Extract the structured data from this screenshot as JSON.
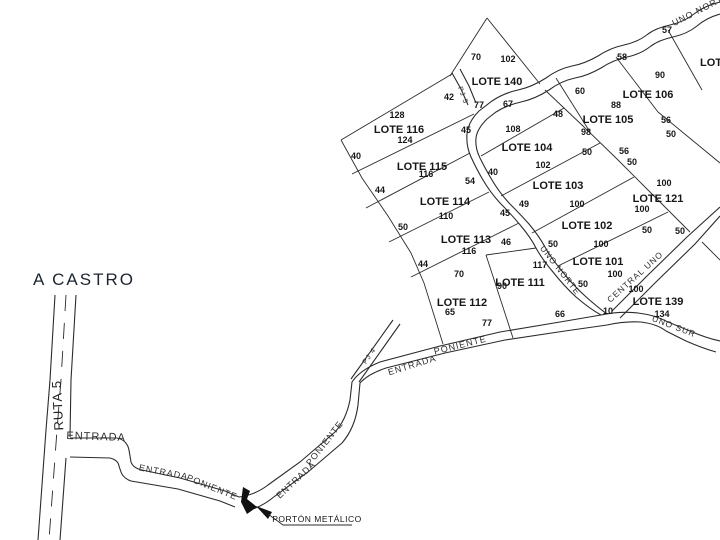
{
  "labels": {
    "a_castro": "A CASTRO",
    "ruta5": "RUTA 5",
    "partial_lot": "LOTE"
  },
  "annotation": {
    "porton": "PORTÓN METÁLICO"
  },
  "colors": {
    "line": "#2b2b2b",
    "text": "#161616",
    "background": "#ffffff"
  },
  "lots": [
    {
      "label": "LOTE 140",
      "x": 497,
      "y": 85
    },
    {
      "label": "LOTE 106",
      "x": 648,
      "y": 98
    },
    {
      "label": "LOTE 105",
      "x": 608,
      "y": 123
    },
    {
      "label": "LOTE 104",
      "x": 527,
      "y": 151
    },
    {
      "label": "LOTE 116",
      "x": 399,
      "y": 133
    },
    {
      "label": "LOTE 115",
      "x": 422,
      "y": 170
    },
    {
      "label": "LOTE 103",
      "x": 558,
      "y": 189
    },
    {
      "label": "LOTE 121",
      "x": 658,
      "y": 202
    },
    {
      "label": "LOTE 114",
      "x": 445,
      "y": 205
    },
    {
      "label": "LOTE 102",
      "x": 587,
      "y": 229
    },
    {
      "label": "LOTE 113",
      "x": 466,
      "y": 243
    },
    {
      "label": "LOTE 101",
      "x": 598,
      "y": 265
    },
    {
      "label": "LOTE 111",
      "x": 520,
      "y": 286
    },
    {
      "label": "LOTE 139",
      "x": 658,
      "y": 305
    },
    {
      "label": "LOTE 112",
      "x": 462,
      "y": 306
    }
  ],
  "dimensions": [
    {
      "t": "70",
      "x": 476,
      "y": 60
    },
    {
      "t": "102",
      "x": 508,
      "y": 62
    },
    {
      "t": "42",
      "x": 449,
      "y": 100
    },
    {
      "t": "77",
      "x": 479,
      "y": 108
    },
    {
      "t": "67",
      "x": 508,
      "y": 107
    },
    {
      "t": "45",
      "x": 466,
      "y": 133
    },
    {
      "t": "108",
      "x": 513,
      "y": 132
    },
    {
      "t": "128",
      "x": 397,
      "y": 118
    },
    {
      "t": "124",
      "x": 405,
      "y": 143
    },
    {
      "t": "40",
      "x": 356,
      "y": 159
    },
    {
      "t": "116",
      "x": 426,
      "y": 177
    },
    {
      "t": "44",
      "x": 380,
      "y": 193
    },
    {
      "t": "54",
      "x": 470,
      "y": 184
    },
    {
      "t": "40",
      "x": 493,
      "y": 175
    },
    {
      "t": "102",
      "x": 543,
      "y": 168
    },
    {
      "t": "48",
      "x": 558,
      "y": 117
    },
    {
      "t": "98",
      "x": 586,
      "y": 135
    },
    {
      "t": "110",
      "x": 446,
      "y": 219
    },
    {
      "t": "50",
      "x": 403,
      "y": 230
    },
    {
      "t": "100",
      "x": 577,
      "y": 207
    },
    {
      "t": "45",
      "x": 505,
      "y": 216
    },
    {
      "t": "49",
      "x": 524,
      "y": 207
    },
    {
      "t": "116",
      "x": 469,
      "y": 254
    },
    {
      "t": "44",
      "x": 423,
      "y": 267
    },
    {
      "t": "46",
      "x": 506,
      "y": 245
    },
    {
      "t": "100",
      "x": 601,
      "y": 247
    },
    {
      "t": "50",
      "x": 553,
      "y": 247
    },
    {
      "t": "70",
      "x": 459,
      "y": 277
    },
    {
      "t": "65",
      "x": 450,
      "y": 315
    },
    {
      "t": "77",
      "x": 487,
      "y": 326
    },
    {
      "t": "90",
      "x": 502,
      "y": 289
    },
    {
      "t": "117",
      "x": 540,
      "y": 268
    },
    {
      "t": "66",
      "x": 560,
      "y": 317
    },
    {
      "t": "100",
      "x": 615,
      "y": 277
    },
    {
      "t": "50",
      "x": 583,
      "y": 287
    },
    {
      "t": "57",
      "x": 667,
      "y": 33
    },
    {
      "t": "58",
      "x": 622,
      "y": 60
    },
    {
      "t": "90",
      "x": 660,
      "y": 78
    },
    {
      "t": "60",
      "x": 580,
      "y": 94
    },
    {
      "t": "88",
      "x": 616,
      "y": 108
    },
    {
      "t": "56",
      "x": 624,
      "y": 154
    },
    {
      "t": "50",
      "x": 632,
      "y": 165
    },
    {
      "t": "56",
      "x": 666,
      "y": 123
    },
    {
      "t": "50",
      "x": 671,
      "y": 137
    },
    {
      "t": "50",
      "x": 587,
      "y": 155
    },
    {
      "t": "100",
      "x": 664,
      "y": 186
    },
    {
      "t": "100",
      "x": 642,
      "y": 212
    },
    {
      "t": "50",
      "x": 647,
      "y": 233
    },
    {
      "t": "50",
      "x": 680,
      "y": 234
    },
    {
      "t": "100",
      "x": 636,
      "y": 292
    },
    {
      "t": "134",
      "x": 662,
      "y": 317
    },
    {
      "t": "10",
      "x": 608,
      "y": 314
    }
  ],
  "road_labels": [
    {
      "t": "UNO NORTE",
      "x": 702,
      "y": 12,
      "r": -27,
      "fs": 9
    },
    {
      "t": "PJ 5",
      "x": 461,
      "y": 96,
      "r": 70,
      "fs": 7
    },
    {
      "t": "UNO NORTE",
      "x": 558,
      "y": 272,
      "r": 52,
      "fs": 8.5
    },
    {
      "t": "CENTRAL UNO",
      "x": 637,
      "y": 279,
      "r": -42,
      "fs": 8.5
    },
    {
      "t": "UNO SUR",
      "x": 673,
      "y": 329,
      "r": 21,
      "fs": 8.5
    },
    {
      "t": "PJ 4",
      "x": 371,
      "y": 357,
      "r": -55,
      "fs": 7
    },
    {
      "t": "ENTRADA",
      "x": 96,
      "y": 440,
      "r": 2,
      "fs": 11
    },
    {
      "t": "ENTRADA",
      "x": 163,
      "y": 475,
      "r": 11,
      "fs": 9
    },
    {
      "t": "PONIENTE",
      "x": 211,
      "y": 490,
      "r": 22,
      "fs": 9
    },
    {
      "t": "ENTRADA",
      "x": 298,
      "y": 482,
      "r": -43,
      "fs": 9
    },
    {
      "t": "PONIENTE",
      "x": 327,
      "y": 445,
      "r": -52,
      "fs": 9
    },
    {
      "t": "ENTRADA",
      "x": 413,
      "y": 368,
      "r": -17,
      "fs": 9
    },
    {
      "t": "PONIENTE",
      "x": 461,
      "y": 348,
      "r": -14,
      "fs": 9
    }
  ]
}
